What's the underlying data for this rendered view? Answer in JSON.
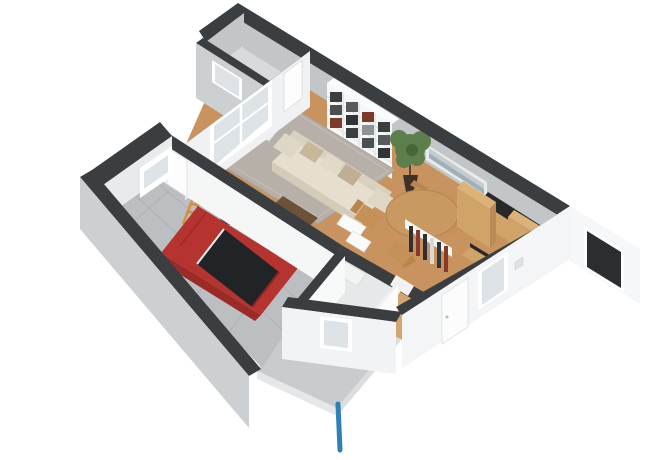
{
  "scene": {
    "type": "3d-floorplan-render",
    "view": "rotated-isometric-top-down",
    "background": "#ffffff",
    "rooms": [
      {
        "name": "storage-room",
        "floor": "light-gray",
        "contents": [
          "small-window"
        ]
      },
      {
        "name": "living-room",
        "floor": "wood",
        "contents": [
          "sofa",
          "pillows",
          "area-rug",
          "coffee-table",
          "armchair",
          "side-table",
          "bookshelf-with-books",
          "potted-plant",
          "wall-art",
          "round-dining-table",
          "dining-chairs",
          "large-window",
          "interior-door"
        ]
      },
      {
        "name": "kitchen",
        "floor": "wood",
        "contents": [
          "tall-cabinet",
          "counter-with-dark-top",
          "cabinet",
          "pantry-shelf"
        ]
      },
      {
        "name": "bathroom",
        "floor": "light-gray",
        "contents": [
          "toilet",
          "shower-tray",
          "wall-stubs"
        ]
      },
      {
        "name": "hallway",
        "floor": "wood",
        "contents": [
          "front-door",
          "windows"
        ]
      },
      {
        "name": "garage",
        "floor": "gray-tiles",
        "contents": [
          "red-car",
          "bicycle",
          "step-ladder",
          "door-to-house",
          "window",
          "open-garage-doorway"
        ]
      }
    ],
    "exterior": [
      "driveway-slab",
      "blue-drain-pipe",
      "white-facade-windows",
      "vent-square"
    ]
  },
  "colors": {
    "wall": "#3b3e41",
    "wall_cap_int": "#eff0f0",
    "int_face": "#c3c6c8",
    "wood": "#c9935f",
    "wood_light": "#d4a571",
    "rug": "#b6b0a8",
    "garage_floor": "#bcbfc1",
    "slab": "#c9cbcd",
    "sofa": "#e6dfcf",
    "table": "#c89a62",
    "chair": "#c49258",
    "cabinet": "#d0a369",
    "countertop": "#26282a",
    "shelf": "#f6f7f7",
    "plant": "#5d7f4b",
    "pot": "#40302a",
    "car": "#b5342f",
    "car_glass": "#212427",
    "glass": "#dde3e7",
    "glass_dark": "#2b2e30",
    "pipe": "#2f80b5",
    "art": "#c3ccd1"
  }
}
